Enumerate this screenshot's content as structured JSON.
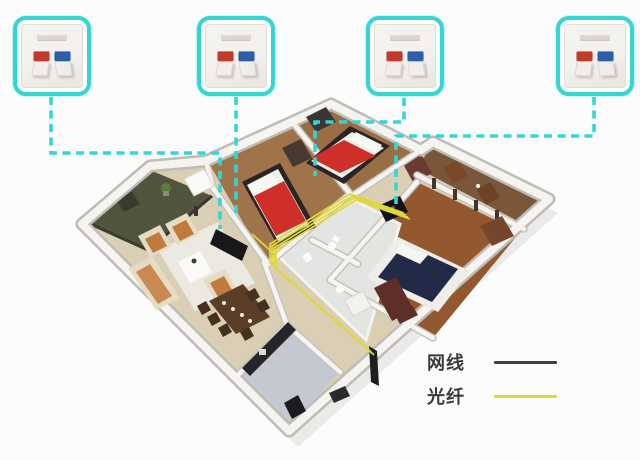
{
  "title": "home-fiber-network-wiring-diagram",
  "colors": {
    "accent_cyan": "#32D7D5",
    "jack_red": "#C13A2C",
    "jack_blue": "#2D5FA8",
    "fiber_yellow": "#DFD83B",
    "cable_black": "#414141",
    "panel_face": "#F3F1EC"
  },
  "wall_outlets": [
    {
      "id": "outlet-1",
      "ports": [
        "red",
        "blue"
      ],
      "x": 13
    },
    {
      "id": "outlet-2",
      "ports": [
        "red",
        "blue"
      ],
      "x": 197
    },
    {
      "id": "outlet-3",
      "ports": [
        "red",
        "blue"
      ],
      "x": 366
    },
    {
      "id": "outlet-4",
      "ports": [
        "red",
        "blue"
      ],
      "x": 556
    }
  ],
  "connections": [
    {
      "from": "outlet-1",
      "to": "living-room-tv-wall",
      "path": [
        [
          51,
          97
        ],
        [
          51,
          153
        ],
        [
          220,
          153
        ],
        [
          220,
          229
        ]
      ]
    },
    {
      "from": "outlet-2",
      "to": "living-room-tv-wall",
      "path": [
        [
          236,
          97
        ],
        [
          236,
          218
        ]
      ]
    },
    {
      "from": "outlet-3",
      "to": "bedroom-2",
      "path": [
        [
          404,
          98
        ],
        [
          404,
          122
        ],
        [
          315,
          122
        ],
        [
          315,
          176
        ]
      ]
    },
    {
      "from": "outlet-4",
      "to": "master-bedroom-dresser",
      "path": [
        [
          594,
          97
        ],
        [
          594,
          136
        ],
        [
          396,
          136
        ],
        [
          396,
          204
        ]
      ]
    }
  ],
  "fiber_route": [
    [
      370,
      352
    ],
    [
      272,
      266
    ],
    [
      272,
      247
    ],
    [
      352,
      197
    ],
    [
      406,
      216
    ]
  ],
  "fiber_branch": [
    [
      272,
      252
    ],
    [
      252,
      234
    ]
  ],
  "legend": {
    "items": [
      {
        "label": "网线",
        "color": "#414141"
      },
      {
        "label": "光纤",
        "color": "#DFD83B"
      }
    ]
  }
}
